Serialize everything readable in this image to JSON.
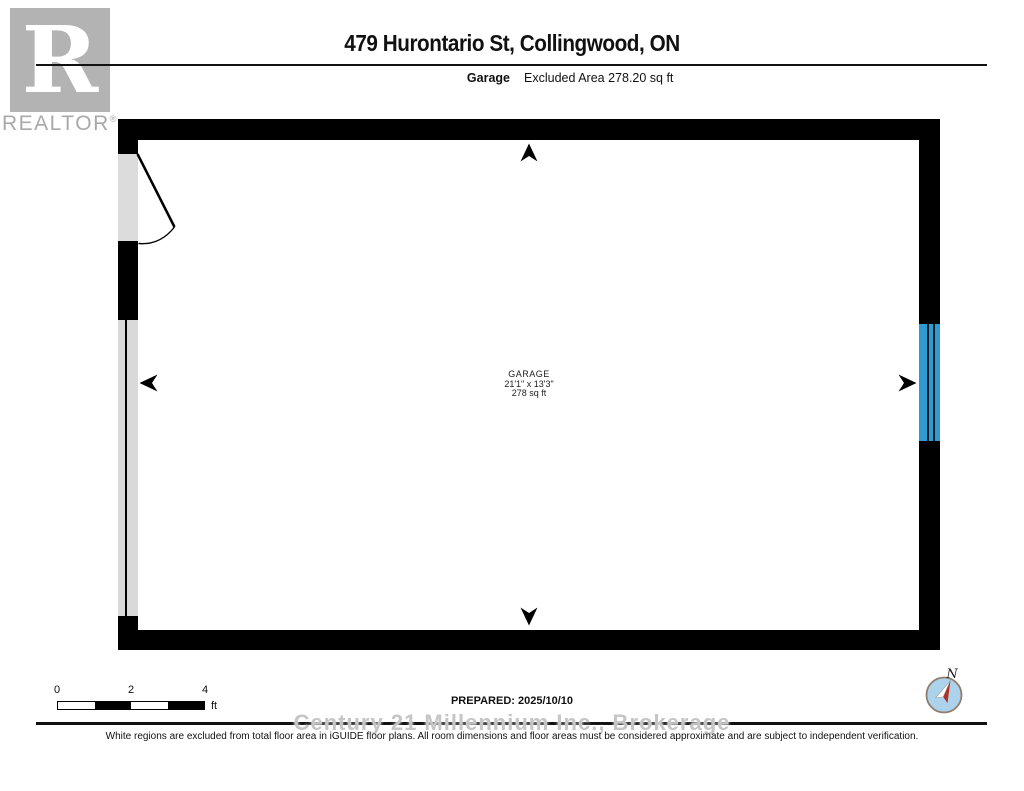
{
  "branding": {
    "logo_letter": "R",
    "wordmark": "REALTOR",
    "registered": "®"
  },
  "header": {
    "title": "479 Hurontario St, Collingwood, ON",
    "floor_label": "Garage",
    "excluded_area": "Excluded Area 278.20 sq ft"
  },
  "floorplan": {
    "room": {
      "name": "GARAGE",
      "dimensions": "21'1\" x 13'3\"",
      "area": "278 sq ft"
    },
    "colors": {
      "wall": "#000000",
      "door_opening": "#dcdcdc",
      "garage_door": "#d9d9d9",
      "window_blue": "#2d9ad2"
    }
  },
  "scalebar": {
    "ticks": [
      "0",
      "2",
      "4"
    ],
    "unit": "ft"
  },
  "footer": {
    "prepared": "PREPARED: 2025/10/10",
    "watermark": "Century 21 Millennium Inc., Brokerage",
    "disclaimer": "White regions are excluded from total floor area in iGUIDE floor plans. All room dimensions and floor areas must be considered approximate and are subject to independent verification."
  },
  "compass": {
    "north_label": "N"
  }
}
